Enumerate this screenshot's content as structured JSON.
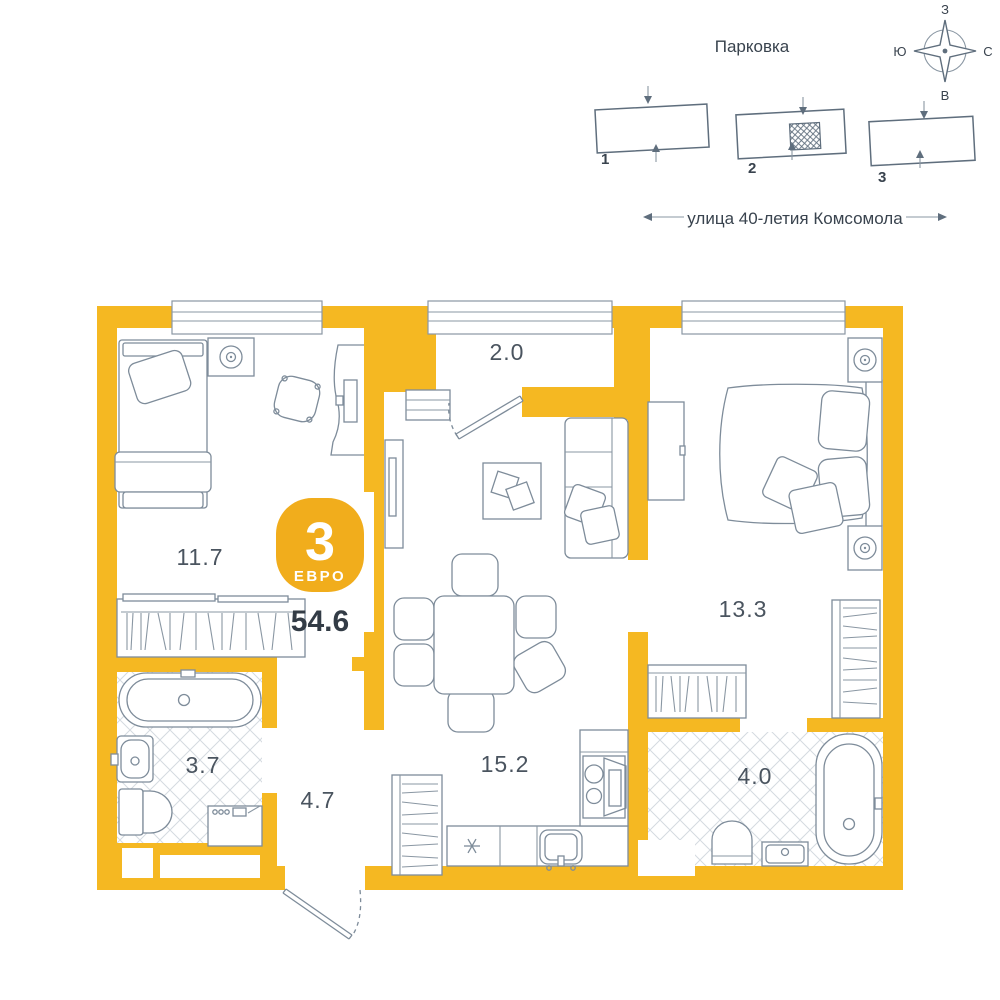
{
  "meta": {
    "background": "#ffffff",
    "wall_color": "#f5b822",
    "badge_color": "#f1ad1c",
    "line_color": "#7e8c9a",
    "text_color": "#39434e",
    "tile_color": "#d4dae0"
  },
  "compass": {
    "top": "З",
    "right": "С",
    "bottom": "В",
    "left": "Ю"
  },
  "parking": {
    "title": "Парковка",
    "buildings": [
      {
        "label": "1",
        "highlighted": false
      },
      {
        "label": "2",
        "highlighted": true
      },
      {
        "label": "3",
        "highlighted": false
      }
    ]
  },
  "street": {
    "name": "улица 40-летия Комсомола"
  },
  "badge": {
    "rooms": "3",
    "type": "ЕВРО",
    "total_area": "54.6"
  },
  "rooms": [
    {
      "id": "entry-hall-top",
      "area": "2.0"
    },
    {
      "id": "bedroom-left",
      "area": "11.7"
    },
    {
      "id": "bedroom-right",
      "area": "13.3"
    },
    {
      "id": "bathroom-left",
      "area": "3.7"
    },
    {
      "id": "hallway",
      "area": "4.7"
    },
    {
      "id": "kitchen-living",
      "area": "15.2"
    },
    {
      "id": "bathroom-right",
      "area": "4.0"
    }
  ]
}
